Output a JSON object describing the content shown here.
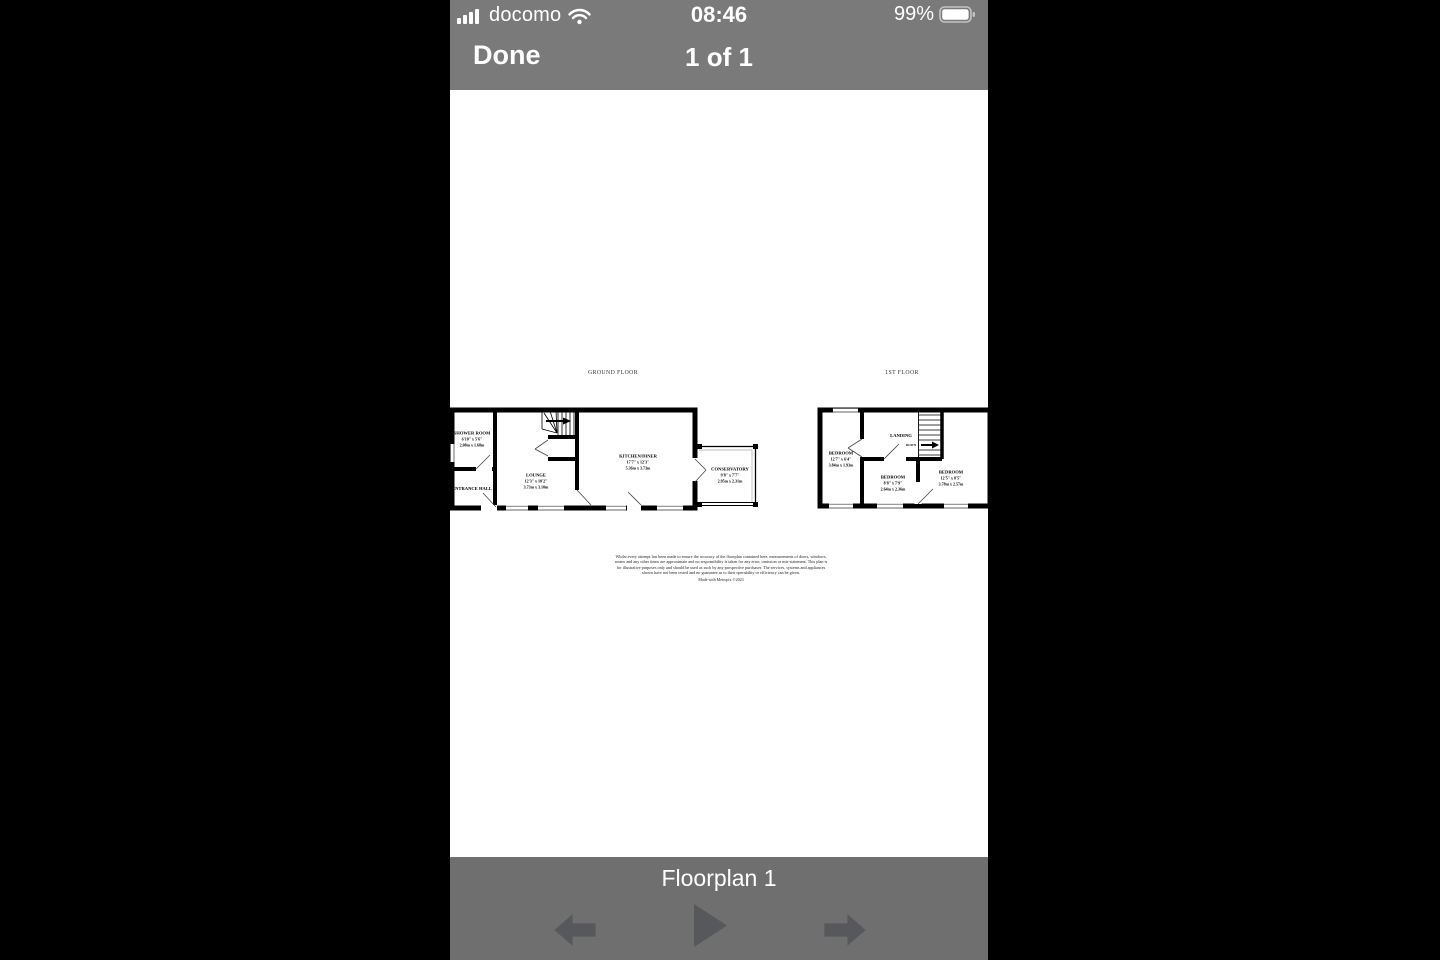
{
  "status_bar": {
    "carrier": "docomo",
    "time": "08:46",
    "battery_percent": "99%"
  },
  "nav_bar": {
    "done_label": "Done",
    "page_indicator": "1 of 1"
  },
  "viewer": {
    "caption": "Floorplan 1"
  },
  "floorplan": {
    "ground": {
      "title": "GROUND FLOOR",
      "rooms": [
        {
          "name": "SHOWER ROOM",
          "imperial": "6'10\" x 5'6\"",
          "metric": "2.08m x 1.68m"
        },
        {
          "name": "ENTRANCE HALL",
          "imperial": "",
          "metric": ""
        },
        {
          "name": "LOUNGE",
          "imperial": "12'3\" x 10'2\"",
          "metric": "3.73m x 3.10m"
        },
        {
          "name": "KITCHEN/DINER",
          "imperial": "17'7\" x 12'3\"",
          "metric": "5.36m x 3.73m"
        },
        {
          "name": "CONSERVATORY",
          "imperial": "9'8\" x 7'7\"",
          "metric": "2.95m x 2.31m"
        }
      ]
    },
    "first": {
      "title": "1ST FLOOR",
      "stairs_label": "DOWN",
      "rooms": [
        {
          "name": "BEDROOM",
          "imperial": "12'7\" x 6'4\"",
          "metric": "3.84m x 1.93m"
        },
        {
          "name": "LANDING",
          "imperial": "",
          "metric": ""
        },
        {
          "name": "BEDROOM",
          "imperial": "8'8\" x 7'9\"",
          "metric": "2.64m x 2.36m"
        },
        {
          "name": "BEDROOM",
          "imperial": "12'5\" x 8'5\"",
          "metric": "3.78m x 2.57m"
        }
      ]
    },
    "disclaimer": "Whilst every attempt has been made to ensure the accuracy of the floorplan contained here, measurements of doors, windows, rooms and any other items are approximate and no responsibility is taken for any error, omission or mis-statement. This plan is for illustrative purposes only and should be used as such by any prospective purchaser. The services, systems and appliances shown have not been tested and no guarantee as to their operability or efficiency can be given.",
    "made_with": "Made with Metropix ©2023"
  },
  "colors": {
    "chrome_top": "#7a7a7b",
    "chrome_bottom": "#6f6f70",
    "arrow": "#56585c",
    "letterbox": "#000000"
  },
  "icons": {
    "signal": "signal-strength-icon",
    "wifi": "wifi-icon",
    "battery": "battery-icon",
    "previous": "previous-photo-icon",
    "play": "slideshow-play-icon",
    "next": "next-photo-icon"
  }
}
